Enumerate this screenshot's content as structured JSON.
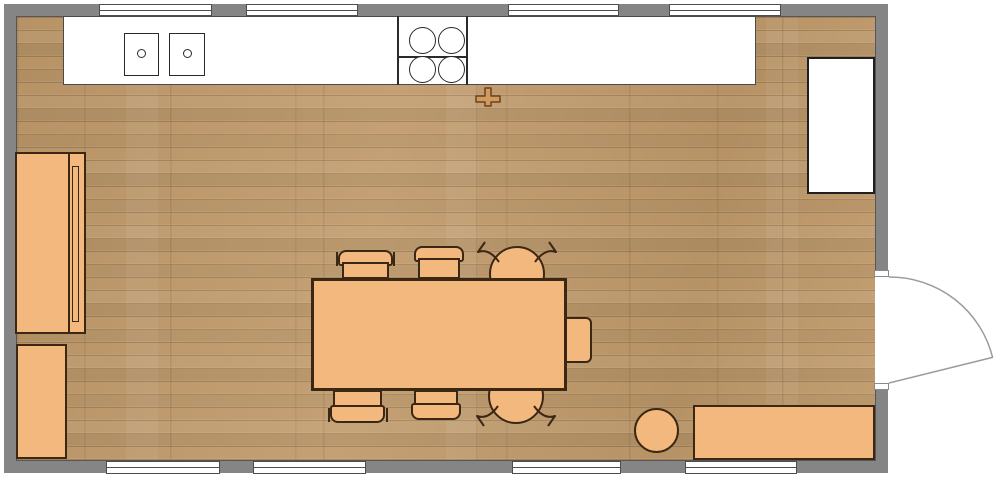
{
  "title": "kitchen-dining-floor-plan",
  "canvas": {
    "w": 1000,
    "h": 497,
    "background": "#ffffff"
  },
  "palette": {
    "wall": "#858585",
    "wall_inner_edge": "#565656",
    "floor_wood": "#C09A6B",
    "furniture_fill": "#F3B87D",
    "furniture_border": "#3A2714",
    "appliance_fill": "#FFFFFF",
    "appliance_border": "#2A2A2A",
    "window_frame": "#4D4D4D",
    "door_stroke": "#9B9B9B",
    "cross_fill": "#D39A5E",
    "cross_stroke": "#6A431F"
  },
  "elements": [
    {
      "name": "room-walls",
      "type": "rect",
      "x": 4,
      "y": 4,
      "w": 884,
      "h": 469,
      "fill": "#858585",
      "inter": false
    },
    {
      "name": "room-floor",
      "type": "rect",
      "cls": "floor",
      "x": 16,
      "y": 16,
      "w": 860,
      "h": 445,
      "stroke": "#565656",
      "sw": 1,
      "inter": false
    },
    {
      "name": "window-top-1",
      "type": "window",
      "x": 99,
      "y": 4,
      "w": 113,
      "h": 12,
      "fill": "#ffffff",
      "stroke": "#4d4d4d",
      "sw": 1,
      "inter": true
    },
    {
      "name": "window-top-2",
      "type": "window",
      "x": 246,
      "y": 4,
      "w": 112,
      "h": 12,
      "fill": "#ffffff",
      "stroke": "#4d4d4d",
      "sw": 1,
      "inter": true
    },
    {
      "name": "window-top-3",
      "type": "window",
      "x": 508,
      "y": 4,
      "w": 111,
      "h": 12,
      "fill": "#ffffff",
      "stroke": "#4d4d4d",
      "sw": 1,
      "inter": true
    },
    {
      "name": "window-top-4",
      "type": "window",
      "x": 669,
      "y": 4,
      "w": 112,
      "h": 12,
      "fill": "#ffffff",
      "stroke": "#4d4d4d",
      "sw": 1,
      "inter": true
    },
    {
      "name": "window-bottom-1",
      "type": "window",
      "x": 106,
      "y": 461,
      "w": 114,
      "h": 13,
      "fill": "#ffffff",
      "stroke": "#4d4d4d",
      "sw": 1,
      "inter": true
    },
    {
      "name": "window-bottom-2",
      "type": "window",
      "x": 253,
      "y": 461,
      "w": 113,
      "h": 13,
      "fill": "#ffffff",
      "stroke": "#4d4d4d",
      "sw": 1,
      "inter": true
    },
    {
      "name": "window-bottom-3",
      "type": "window",
      "x": 512,
      "y": 461,
      "w": 109,
      "h": 13,
      "fill": "#ffffff",
      "stroke": "#4d4d4d",
      "sw": 1,
      "inter": true
    },
    {
      "name": "window-bottom-4",
      "type": "window",
      "x": 685,
      "y": 461,
      "w": 112,
      "h": 13,
      "fill": "#ffffff",
      "stroke": "#4d4d4d",
      "sw": 1,
      "inter": true
    },
    {
      "name": "door-opening",
      "type": "rect",
      "x": 875,
      "y": 277,
      "w": 14,
      "h": 106,
      "fill": "#ffffff",
      "inter": false
    },
    {
      "name": "door-jamb-top",
      "type": "rect",
      "x": 874,
      "y": 270,
      "w": 15,
      "h": 7,
      "fill": "#ffffff",
      "stroke": "#8a8a8a",
      "sw": 1,
      "inter": false
    },
    {
      "name": "door-jamb-bottom",
      "type": "rect",
      "x": 874,
      "y": 383,
      "w": 15,
      "h": 7,
      "fill": "#ffffff",
      "stroke": "#8a8a8a",
      "sw": 1,
      "inter": false
    },
    {
      "name": "kitchen-counter",
      "type": "rect",
      "x": 63,
      "y": 16,
      "w": 693,
      "h": 69,
      "fill": "#ffffff",
      "stroke": "#4a4a4a",
      "sw": 1,
      "inter": true
    },
    {
      "name": "sink-basin-left",
      "type": "rect",
      "x": 124,
      "y": 33,
      "w": 35,
      "h": 43,
      "fill": "#ffffff",
      "stroke": "#2a2a2a",
      "sw": 1.5,
      "inter": true
    },
    {
      "name": "sink-drain-left",
      "type": "circle",
      "x": 137,
      "y": 49,
      "w": 9,
      "h": 9,
      "fill": "#ffffff",
      "stroke": "#2a2a2a",
      "sw": 1.5,
      "inter": false
    },
    {
      "name": "sink-basin-right",
      "type": "rect",
      "x": 169,
      "y": 33,
      "w": 36,
      "h": 43,
      "fill": "#ffffff",
      "stroke": "#2a2a2a",
      "sw": 1.5,
      "inter": true
    },
    {
      "name": "sink-drain-right",
      "type": "circle",
      "x": 183,
      "y": 49,
      "w": 9,
      "h": 9,
      "fill": "#ffffff",
      "stroke": "#2a2a2a",
      "sw": 1.5,
      "inter": false
    },
    {
      "name": "cooktop-left-edge",
      "type": "rect",
      "x": 397,
      "y": 16,
      "w": 2,
      "h": 69,
      "fill": "#2a2a2a",
      "inter": false
    },
    {
      "name": "cooktop-right-edge",
      "type": "rect",
      "x": 466,
      "y": 16,
      "w": 2,
      "h": 69,
      "fill": "#2a2a2a",
      "inter": false
    },
    {
      "name": "cooktop-mid-line",
      "type": "rect",
      "x": 399,
      "y": 56,
      "w": 67,
      "h": 2,
      "fill": "#2a2a2a",
      "inter": false
    },
    {
      "name": "cooktop-burner-1",
      "type": "circle",
      "x": 409,
      "y": 27,
      "w": 27,
      "h": 27,
      "fill": "#ffffff",
      "stroke": "#2a2a2a",
      "sw": 1.5,
      "inter": true
    },
    {
      "name": "cooktop-burner-2",
      "type": "circle",
      "x": 438,
      "y": 27,
      "w": 27,
      "h": 27,
      "fill": "#ffffff",
      "stroke": "#2a2a2a",
      "sw": 1.5,
      "inter": true
    },
    {
      "name": "cooktop-burner-3",
      "type": "circle",
      "x": 409,
      "y": 56,
      "w": 27,
      "h": 27,
      "fill": "#ffffff",
      "stroke": "#2a2a2a",
      "sw": 1.5,
      "inter": true
    },
    {
      "name": "cooktop-burner-4",
      "type": "circle",
      "x": 438,
      "y": 56,
      "w": 27,
      "h": 27,
      "fill": "#ffffff",
      "stroke": "#2a2a2a",
      "sw": 1.5,
      "inter": true
    },
    {
      "name": "refrigerator",
      "type": "rect",
      "x": 807,
      "y": 57,
      "w": 68,
      "h": 137,
      "fill": "#ffffff",
      "stroke": "#1f1f1f",
      "sw": 2,
      "inter": true
    },
    {
      "name": "wardrobe",
      "type": "rect",
      "x": 15,
      "y": 152,
      "w": 71,
      "h": 182,
      "fill": "#F3B87D",
      "stroke": "#3A2714",
      "sw": 2,
      "inter": true
    },
    {
      "name": "wardrobe-divider",
      "type": "rect",
      "x": 68,
      "y": 152,
      "w": 2,
      "h": 182,
      "fill": "#3A2714",
      "inter": false
    },
    {
      "name": "wardrobe-door-panel",
      "type": "rect",
      "x": 72,
      "y": 166,
      "w": 7,
      "h": 156,
      "fill": "#F3B87D",
      "stroke": "#3A2714",
      "sw": 1.5,
      "inter": false
    },
    {
      "name": "cabinet",
      "type": "rect",
      "x": 16,
      "y": 344,
      "w": 51,
      "h": 115,
      "fill": "#F3B87D",
      "stroke": "#3A2714",
      "sw": 2,
      "inter": true
    },
    {
      "name": "armchair-top",
      "type": "circle",
      "x": 489,
      "y": 246,
      "w": 56,
      "h": 56,
      "fill": "#F3B87D",
      "stroke": "#3A2714",
      "sw": 2,
      "inter": true
    },
    {
      "name": "armchair-bottom",
      "type": "circle",
      "x": 488,
      "y": 368,
      "w": 56,
      "h": 56,
      "fill": "#F3B87D",
      "stroke": "#3A2714",
      "sw": 2,
      "inter": true
    },
    {
      "name": "chair-top-1-back",
      "type": "rect",
      "x": 338,
      "y": 250,
      "w": 55,
      "h": 16,
      "radius": "8px 8px 3px 3px",
      "fill": "#F3B87D",
      "stroke": "#3A2714",
      "sw": 2,
      "inter": true
    },
    {
      "name": "chair-top-1-seat",
      "type": "rect",
      "x": 342,
      "y": 262,
      "w": 47,
      "h": 17,
      "fill": "#F3B87D",
      "stroke": "#3A2714",
      "sw": 2,
      "inter": true
    },
    {
      "name": "chair-top-1-leg-left",
      "type": "rect",
      "x": 336,
      "y": 252,
      "w": 2,
      "h": 14,
      "fill": "#3A2714",
      "inter": false
    },
    {
      "name": "chair-top-1-leg-right",
      "type": "rect",
      "x": 393,
      "y": 252,
      "w": 2,
      "h": 14,
      "fill": "#3A2714",
      "inter": false
    },
    {
      "name": "chair-top-2-back",
      "type": "rect",
      "x": 414,
      "y": 246,
      "w": 50,
      "h": 16,
      "radius": "8px 8px 3px 3px",
      "fill": "#F3B87D",
      "stroke": "#3A2714",
      "sw": 2,
      "inter": true
    },
    {
      "name": "chair-top-2-seat",
      "type": "rect",
      "x": 418,
      "y": 258,
      "w": 42,
      "h": 21,
      "fill": "#F3B87D",
      "stroke": "#3A2714",
      "sw": 2,
      "inter": true
    },
    {
      "name": "chair-bottom-1-seat",
      "type": "rect",
      "x": 333,
      "y": 390,
      "w": 49,
      "h": 18,
      "fill": "#F3B87D",
      "stroke": "#3A2714",
      "sw": 2,
      "inter": true
    },
    {
      "name": "chair-bottom-1-back",
      "type": "rect",
      "x": 330,
      "y": 405,
      "w": 55,
      "h": 18,
      "radius": "3px 3px 8px 8px",
      "fill": "#F3B87D",
      "stroke": "#3A2714",
      "sw": 2,
      "inter": true
    },
    {
      "name": "chair-bottom-1-leg-left",
      "type": "rect",
      "x": 328,
      "y": 408,
      "w": 2,
      "h": 14,
      "fill": "#3A2714",
      "inter": false
    },
    {
      "name": "chair-bottom-1-leg-right",
      "type": "rect",
      "x": 386,
      "y": 408,
      "w": 2,
      "h": 14,
      "fill": "#3A2714",
      "inter": false
    },
    {
      "name": "chair-bottom-2-seat",
      "type": "rect",
      "x": 414,
      "y": 390,
      "w": 44,
      "h": 16,
      "fill": "#F3B87D",
      "stroke": "#3A2714",
      "sw": 2,
      "inter": true
    },
    {
      "name": "chair-bottom-2-back",
      "type": "rect",
      "x": 411,
      "y": 403,
      "w": 50,
      "h": 17,
      "radius": "3px 3px 8px 8px",
      "fill": "#F3B87D",
      "stroke": "#3A2714",
      "sw": 2,
      "inter": true
    },
    {
      "name": "end-chair",
      "type": "rect",
      "x": 565,
      "y": 317,
      "w": 27,
      "h": 46,
      "radius": "0 6px 6px 0",
      "fill": "#F3B87D",
      "stroke": "#3A2714",
      "sw": 2,
      "inter": true
    },
    {
      "name": "dining-table",
      "type": "rect",
      "x": 311,
      "y": 278,
      "w": 256,
      "h": 113,
      "fill": "#F3B87D",
      "stroke": "#3A2714",
      "sw": 3,
      "inter": true
    },
    {
      "name": "stool",
      "type": "circle",
      "x": 634,
      "y": 408,
      "w": 45,
      "h": 45,
      "fill": "#F3B87D",
      "stroke": "#3A2714",
      "sw": 2,
      "inter": true
    },
    {
      "name": "sideboard",
      "type": "rect",
      "x": 693,
      "y": 405,
      "w": 182,
      "h": 55,
      "fill": "#F3B87D",
      "stroke": "#3A2714",
      "sw": 2,
      "inter": true
    },
    {
      "name": "fixture-cross-symbol",
      "type": "path",
      "d": "M485 88 L491 88 L491 96 L500 96 L500 102 L491 102 L491 106 L485 106 L485 102 L476 102 L476 96 L485 96 Z",
      "fill": "#D39A5E",
      "stroke": "#6A431F",
      "sw": 1.5,
      "inter": true
    },
    {
      "name": "armchair-top-arm-left",
      "type": "path",
      "d": "M499 262 Q489 248 478 252 L485 242",
      "fill": "none",
      "stroke": "#3A2714",
      "sw": 2,
      "inter": false
    },
    {
      "name": "armchair-top-arm-right",
      "type": "path",
      "d": "M535 262 Q545 248 556 252 L549 242",
      "fill": "none",
      "stroke": "#3A2714",
      "sw": 2,
      "inter": false
    },
    {
      "name": "armchair-bottom-arm-left",
      "type": "path",
      "d": "M498 406 Q488 420 477 416 L484 426",
      "fill": "none",
      "stroke": "#3A2714",
      "sw": 2,
      "inter": false
    },
    {
      "name": "armchair-bottom-arm-right",
      "type": "path",
      "d": "M534 406 Q544 420 555 416 L548 426",
      "fill": "none",
      "stroke": "#3A2714",
      "sw": 2,
      "inter": false
    },
    {
      "name": "door-swing",
      "type": "path",
      "d": "M889 277 A106 106 0 0 1 992.6 357.4 L889 383",
      "fill": "none",
      "stroke": "#9B9B9B",
      "sw": 1.5,
      "inter": true
    }
  ]
}
